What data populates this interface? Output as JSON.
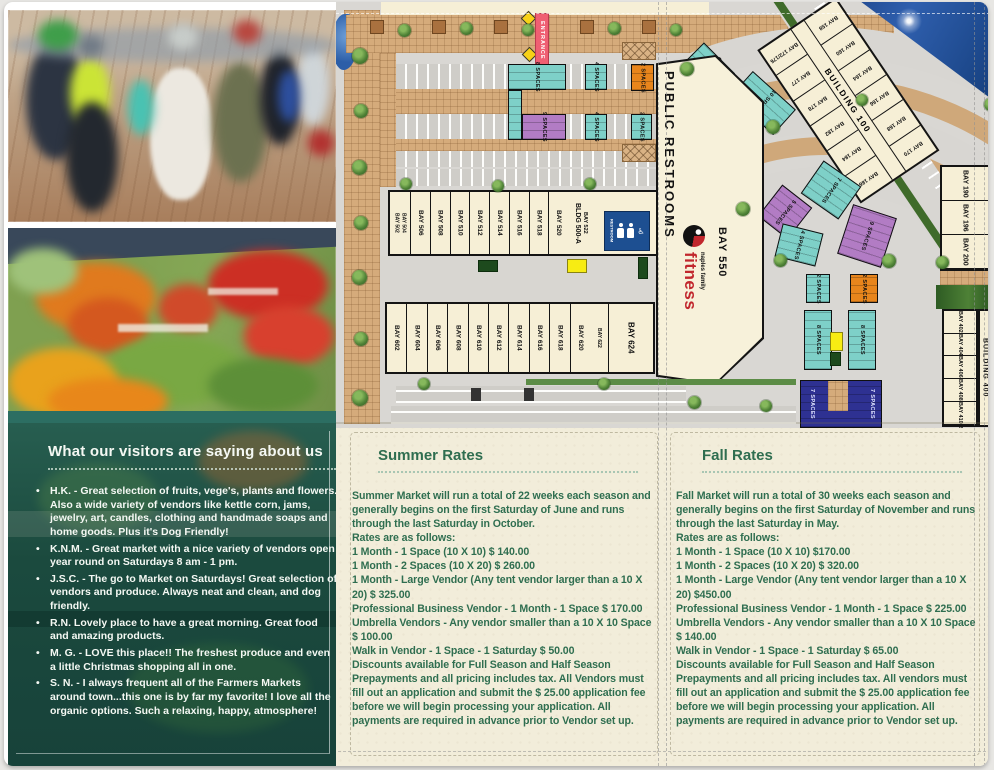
{
  "palette": {
    "cream": "#f2edda",
    "green_text": "#2f6e50",
    "teal_panel": "#1d5347",
    "map_teal": "#7ed0c8",
    "map_purple": "#b27cc4",
    "map_orange": "#e8851c",
    "map_navy": "#2e3192",
    "map_yellow": "#f7ec13",
    "entrance_red": "#ef5f72",
    "restroom_blue": "#1d4f91",
    "fitness_red": "#c1272d"
  },
  "images": {
    "top_photo": "crowd shopping at farmers market",
    "bottom_photo": "fresh produce display"
  },
  "testimonials": {
    "title": "What our visitors are saying about us",
    "items": [
      "H.K. - Great selection of fruits, vege's, plants and flowers. Also a wide variety of vendors like kettle corn, jams, jewelry, art, candles, clothing and handmade soaps and home goods. Plus it's Dog Friendly!",
      "K.N.M. - Great market with a nice variety of vendors open year round on Saturdays 8 am - 1 pm.",
      "J.S.C. - The go to Market on Saturdays! Great selection of vendors and produce. Always neat and clean, and dog friendly.",
      "R.N. Lovely place to have a great morning. Great food and amazing products.",
      "M. G. - LOVE this place!! The freshest produce and even a little Christmas shopping all in one.",
      "S. N. - I always frequent all of the Farmers Markets around town...this one is by far my favorite! I love all the organic options. Such a relaxing, happy, atmosphere!"
    ]
  },
  "summer": {
    "title": "Summer Rates",
    "lines": [
      "Summer Market will run a total of 22 weeks each season and generally begins on the first Saturday of June and runs through the last Saturday in October.",
      "Rates are as follows:",
      "1 Month - 1 Space (10 X 10) $ 140.00",
      "1 Month - 2 Spaces (10 X 20) $ 260.00",
      "1 Month - Large Vendor (Any tent vendor larger than a 10 X 20) $ 325.00",
      "Professional Business Vendor - 1 Month - 1 Space $ 170.00",
      "Umbrella Vendors - Any vendor smaller than a 10 X 10 Space $ 100.00",
      "Walk in Vendor - 1 Space - 1 Saturday $ 50.00",
      "Discounts available for Full Season and Half Season Prepayments and all pricing includes tax. All Vendors must fill out an application and submit the $ 25.00 application fee before we will begin processing your application. All payments are required in advance prior to Vendor set up."
    ]
  },
  "fall": {
    "title": "Fall Rates",
    "lines": [
      "Fall Market will run a total of 30 weeks each season and generally begins on the first Saturday of November and runs through the last Saturday in May.",
      "Rates are as follows:",
      "1 Month - 1 Space (10 X 10)  $170.00",
      "1 Month - 2 Spaces (10 X 20) $ 320.00",
      "1 Month - Large Vendor (Any tent vendor larger than a 10 X 20)  $450.00",
      "Professional Business Vendor  - 1 Month - 1 Space $ 225.00",
      "Umbrella Vendors - Any vendor smaller than a 10 X 10 Space $ 140.00",
      "Walk in Vendor - 1 Space - 1 Saturday $ 65.00",
      "Discounts available for Full Season and Half Season Prepayments and all pricing includes tax. All vendors must fill out an application and submit the $ 25.00 application fee before we will begin processing your application. All payments are required in advance prior to Vendor set up."
    ]
  },
  "map": {
    "entrance": "ENTRANCE",
    "public_restrooms": "PUBLIC RESTROOMS",
    "restroom_sign": "RESTROOM",
    "fitness_brand": "fitness",
    "fitness_sub": "naples family",
    "bay_550": "BAY 550",
    "bldg_500a": "BLDG 500-A",
    "bay_522": "BAY 522",
    "bay_502": "BAY 502",
    "bay_504": "BAY 504",
    "row500": [
      "BAY 506",
      "BAY 508",
      "BAY 510",
      "BAY 512",
      "BAY 514",
      "BAY 516",
      "BAY 518",
      "BAY 520"
    ],
    "row600": [
      "BAY 602",
      "BAY 604",
      "BAY 606",
      "BAY 608",
      "BAY 610",
      "BAY 612",
      "BAY 614",
      "BAY 616",
      "BAY 618",
      "BAY 620"
    ],
    "bay_622": "BAY 622",
    "bay_624": "BAY 624",
    "building_100": "BUILDING 100",
    "b100_row1": [
      "BAY 158",
      "BAY 160",
      "BAY 164",
      "BAY 166",
      "BAY 168",
      "BAY 170"
    ],
    "b100_row2": [
      "BAY 172/176",
      "BAY 177",
      "BAY 178",
      "BAY 182",
      "BAY 184",
      "BAY 186"
    ],
    "right_bays": [
      "BAY 190",
      "BAY 196",
      "BAY 200"
    ],
    "building_400": "BUILDING 400",
    "b400_bays": [
      "BAY 402",
      "BAY 404",
      "BAY 406",
      "BAY 408",
      "BAY 410",
      "BAY 412"
    ],
    "spaces": {
      "c8": "8 SPACES",
      "c9": "9 SPACES",
      "c4a": "4 SPACES",
      "c4b": "4 SPACES",
      "c2a": "2 SPACES",
      "c2b": "2 SPACES",
      "a6": "6 SPACES",
      "a10": "10 SPACES",
      "a4a": "4 SPACES",
      "a4b": "4 SPACES",
      "a4c": "4 SPACES",
      "a7": "7 SPACES",
      "a5": "5 SPACES",
      "a9": "9 SPACES",
      "a4d": "4 SPACES",
      "l2a": "2 SPACES",
      "l2b": "2 SPACES",
      "l8a": "8 SPACES",
      "l8b": "8 SPACES",
      "l7a": "7 SPACES",
      "l7b": "7 SPACES"
    }
  }
}
